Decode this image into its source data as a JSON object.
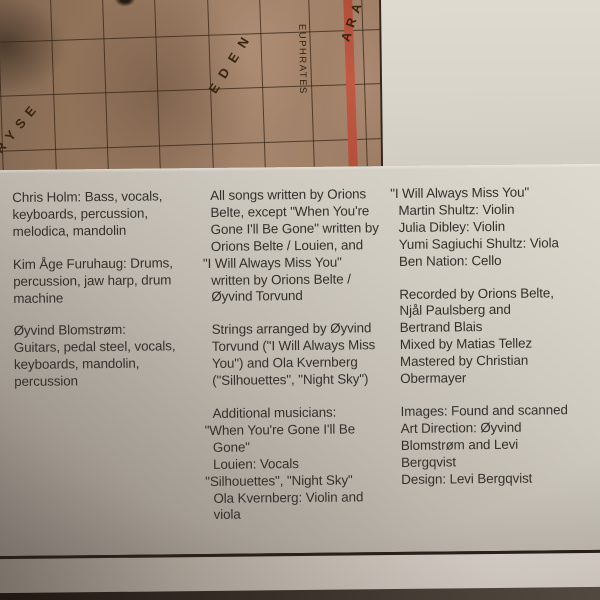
{
  "map": {
    "label_chryse": "HRYSE",
    "label_eden": "EDEN",
    "label_euphrates": "EUPHRATES",
    "label_arabia": "ARA",
    "base_color": "#9b7c63",
    "grid_line_color": "#342314",
    "red_line_color": "#b54c38"
  },
  "card": {
    "paper_color": "#d5d0c5",
    "text_color": "#33302b"
  },
  "credits": {
    "columns": [
      {
        "paragraphs": [
          [
            "Chris Holm: Bass, vocals,",
            "keyboards, percussion,",
            "melodica, mandolin"
          ],
          [
            "Kim Åge Furuhaug: Drums,",
            "percussion, jaw harp, drum",
            "machine"
          ],
          [
            "Øyvind Blomstrøm:",
            "Guitars, pedal steel, vocals,",
            "keyboards, mandolin,",
            "percussion"
          ]
        ]
      },
      {
        "paragraphs": [
          [
            "All songs written by Orions",
            "Belte, except \"When You're",
            "Gone I'll Be Gone\" written by",
            "Orions Belte / Louien, and",
            "\"I Will Always Miss You\"",
            "written by Orions Belte /",
            "Øyvind Torvund"
          ],
          [
            "Strings arranged by Øyvind",
            "Torvund (\"I Will Always Miss",
            "You\") and Ola Kvernberg",
            "(\"Silhouettes\", \"Night Sky\")"
          ],
          [
            "Additional musicians:",
            "\"When You're Gone I'll Be",
            "Gone\"",
            "Louien: Vocals",
            "\"Silhouettes\", \"Night Sky\"",
            "Ola Kvernberg: Violin and",
            "viola"
          ]
        ]
      },
      {
        "paragraphs": [
          [
            "\"I Will Always Miss You\"",
            "Martin Shultz: Violin",
            "Julia Dibley: Violin",
            "Yumi Sagiuchi Shultz: Viola",
            "Ben Nation: Cello"
          ],
          [
            "Recorded by Orions Belte,",
            "Njål Paulsberg and",
            "Bertrand Blais",
            "Mixed by Matias Tellez",
            "Mastered by Christian",
            "Obermayer"
          ],
          [
            "Images: Found and scanned",
            "Art Direction: Øyvind",
            "Blomstrøm and Levi",
            "Bergqvist",
            "Design: Levi Bergqvist"
          ]
        ]
      }
    ]
  }
}
